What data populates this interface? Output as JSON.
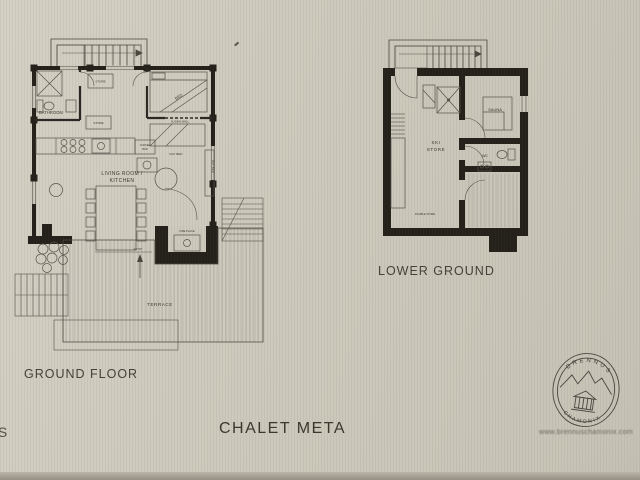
{
  "title": "CHALET META",
  "edge_text": "IS",
  "colors": {
    "paper": "#cdc9bc",
    "wall_ink": "#24211b",
    "line_ink": "#4b473e",
    "label_ink": "#3b382f"
  },
  "ground_floor": {
    "label": "GROUND FLOOR",
    "bathroom": "BATHROOM",
    "store_upper": "STORE",
    "store_lower": "STORE",
    "bed": "BED",
    "sliding_wall": "SLIDING WALL",
    "day_bed": "DAY BED",
    "day_bed_side": "DAY BED",
    "coffee_bar_line1": "COFFEE",
    "coffee_bar_line2": "BAR",
    "living_line1": "LIVING ROOM /",
    "living_line2": "KITCHEN",
    "fire_place": "FIRE PLACE",
    "entry": "ENTRY",
    "terrace": "TERRACE"
  },
  "lower_ground": {
    "label": "LOWER GROUND",
    "ski_line1": "SKI",
    "ski_line2": "STORE",
    "sauna": "SAUNA",
    "wc": "WC",
    "double_store": "DOUBLE STORE"
  },
  "logo": {
    "arc_top": "BRENNUS",
    "arc_bottom": "CHAMONIX",
    "url": "www.brennuschamonix.com"
  }
}
